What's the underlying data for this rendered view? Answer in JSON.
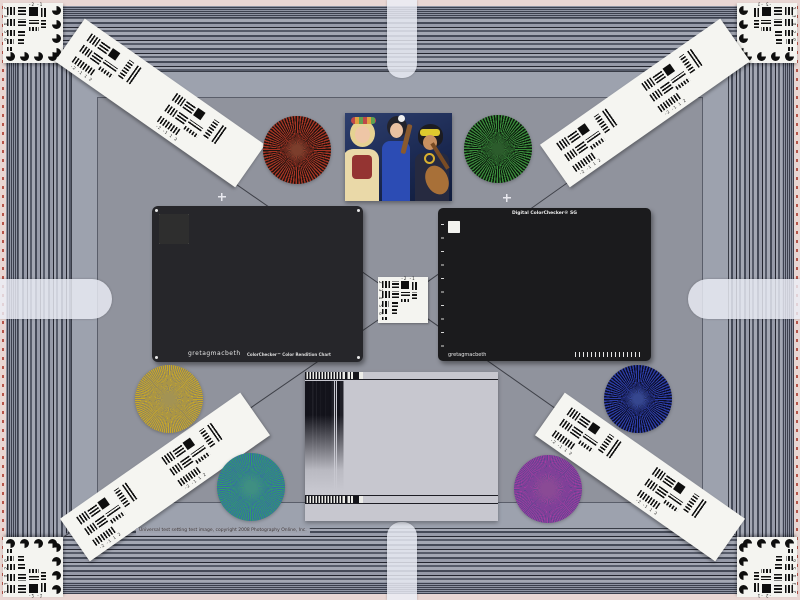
{
  "meta": {
    "description": "Camera universal test chart scene: striped resolution frame, ColorChecker charts, Siemens stars, USAF targets, frequency sweep and portrait photo",
    "background": "#90939d"
  },
  "caption": {
    "text": "Universal test setting test image, copyright 2008 Photography Online, Inc."
  },
  "usaf": {
    "top_labels": "-2  -1",
    "side_labels": "2 3 4 5 6",
    "strip_labels": "-2 -1 1 2"
  },
  "classic_chart": {
    "brand": "gretagmacbeth",
    "title": "ColorChecker™ Color Rendition Chart",
    "patches": [
      "#8a5a44",
      "#d8a288",
      "#6888bc",
      "#5a7038",
      "#9a94d8",
      "#7cccb4",
      "#d8952c",
      "#5a70d4",
      "#e06878",
      "#643e90",
      "#aac838",
      "#dcae24",
      "#3844c4",
      "#48a048",
      "#c03034",
      "#e4d428",
      "#cc60b0",
      "#38a8cc",
      "#f0f0ec",
      "#d8d8d4",
      "#b0b0ac",
      "#848484",
      "#5a5a5a",
      "#2e2e2e"
    ]
  },
  "sg_chart": {
    "title": "Digital ColorChecker® SG",
    "brand": "gretagmacbeth",
    "rows": [
      [
        "#f2f2ee",
        "#a6a6a6",
        "#222222",
        "#f2f2ee",
        "#a6a6a6",
        "#222222",
        "#f2f2ee",
        "#a6a6a6",
        "#222222",
        "#f2f2ee",
        "#a6a6a6",
        "#222222",
        "#a6a6a6",
        "#f2f2ee"
      ],
      [
        "#222222",
        "#b04890",
        "#3c2a6c",
        "#dcd8ec",
        "#8c4a30",
        "#eaa28c",
        "#4066ca",
        "#3c5c22",
        "#8c82d4",
        "#82d2c2",
        "#eacaca",
        "#7c2136",
        "#d24272",
        "#a6a6a6"
      ],
      [
        "#a6a6a6",
        "#caa4da",
        "#5c6ac2",
        "#eca4bc",
        "#d28c1e",
        "#2c3c90",
        "#3c8c3e",
        "#6e3ca0",
        "#decc26",
        "#bc981e",
        "#ecead2",
        "#ca2c2e",
        "#722034",
        "#222222"
      ],
      [
        "#f2f2ee",
        "#7e3ca2",
        "#5238bc",
        "#aaeada",
        "#2a5aca",
        "#2ca22c",
        "#c62424",
        "#e4d424",
        "#d44aa4",
        "#2caadc",
        "#f2d4dc",
        "#ea7c9c",
        "#d42a46",
        "#f2f2ee"
      ],
      [
        "#222222",
        "#3cbada",
        "#1e2c5e",
        "#f2e2e2",
        "#f4f4f0",
        "#dadad6",
        "#b2b2ae",
        "#868686",
        "#5c5c5c",
        "#222222",
        "#caeaf2",
        "#f2aab4",
        "#d24244",
        "#a6a6a6"
      ],
      [
        "#a6a6a6",
        "#8ccaea",
        "#1e2c6a",
        "#ecead0",
        "#1e1e1e",
        "#5a5a5a",
        "#909090",
        "#a4a4a4",
        "#f4f4f0",
        "#f4f4f0",
        "#a4a4a4",
        "#da841e",
        "#eaca1e",
        "#222222"
      ],
      [
        "#f2f2ee",
        "#1e4c4c",
        "#161616",
        "#d49c5a",
        "#ecba92",
        "#d4aa7a",
        "#32302e",
        "#eaaa7a",
        "#ca7a3a",
        "#eac2a2",
        "#8e8e8e",
        "#d4861e",
        "#ead41e",
        "#f2f2ee"
      ],
      [
        "#222222",
        "#5acaba",
        "#1e2c4c",
        "#ea929a",
        "#eaaa92",
        "#eac2b2",
        "#222220",
        "#d4a26a",
        "#8c5a2a",
        "#eaba9a",
        "#5a5a5a",
        "#aa9a1a",
        "#caca2a",
        "#a6a6a6"
      ],
      [
        "#a6a6a6",
        "#2c2c1a",
        "#8aca5a",
        "#3aa24a",
        "#1a1a1a",
        "#1e6c5a",
        "#222222",
        "#3aa23a",
        "#4ab24a",
        "#ba9a1c",
        "#bac82a",
        "#aaba1a",
        "#4c2c1a",
        "#222222"
      ],
      [
        "#f2f2ee",
        "#a6a6a6",
        "#222222",
        "#f2f2ee",
        "#a6a6a6",
        "#222222",
        "#f2f2ee",
        "#a6a6a6",
        "#222222",
        "#f2f2ee",
        "#a6a6a6",
        "#222222",
        "#a6a6a6",
        "#f2f2ee"
      ]
    ]
  },
  "stars": [
    {
      "name": "red",
      "x": 297,
      "y": 150,
      "r": 34,
      "step": 2.5,
      "blur": 9,
      "a": "#a63424",
      "b": "#1f1410",
      "center": "#7c3e2c"
    },
    {
      "name": "green",
      "x": 498,
      "y": 149,
      "r": 34,
      "step": 2.5,
      "blur": 9,
      "a": "#3a8c3c",
      "b": "#0c180c",
      "center": "#2c5c2c"
    },
    {
      "name": "gold",
      "x": 169,
      "y": 399,
      "r": 34,
      "step": 1.8,
      "blur": 10,
      "a": "#c9a928",
      "b": "#8b8162",
      "center": "#a39353"
    },
    {
      "name": "blue",
      "x": 638,
      "y": 399,
      "r": 34,
      "step": 2.5,
      "blur": 9,
      "a": "#2c3da6",
      "b": "#0b0d26",
      "center": "#36478f"
    },
    {
      "name": "teal",
      "x": 251,
      "y": 487,
      "r": 34,
      "step": 2.0,
      "blur": 10,
      "a": "#2f9e68",
      "b": "#3968a8",
      "center": "#3f8f82"
    },
    {
      "name": "magenta",
      "x": 548,
      "y": 489,
      "r": 34,
      "step": 1.5,
      "blur": 12,
      "a": "#a13da0",
      "b": "#5f4490",
      "center": "#8a4a95"
    }
  ],
  "sweep": {
    "tick_periods": [
      12,
      8,
      5,
      3
    ],
    "tick_widths": [
      30,
      26,
      24,
      20
    ],
    "bar_periods": [
      16,
      11,
      8,
      6,
      4.5,
      3
    ],
    "bar_widths": [
      20,
      18,
      17,
      16,
      15,
      14
    ],
    "steps": [
      "#101010",
      "#ececec",
      "#d6d6d6",
      "#c8c8c8",
      "#bcbcbc",
      "#b0b0b0",
      "#a4a4a4",
      "#989898",
      "#8c8c8c",
      "#808080",
      "#747474",
      "#686868",
      "#5c5c5c",
      "#525252",
      "#484848",
      "#404040",
      "#ececec",
      "#101010"
    ]
  }
}
